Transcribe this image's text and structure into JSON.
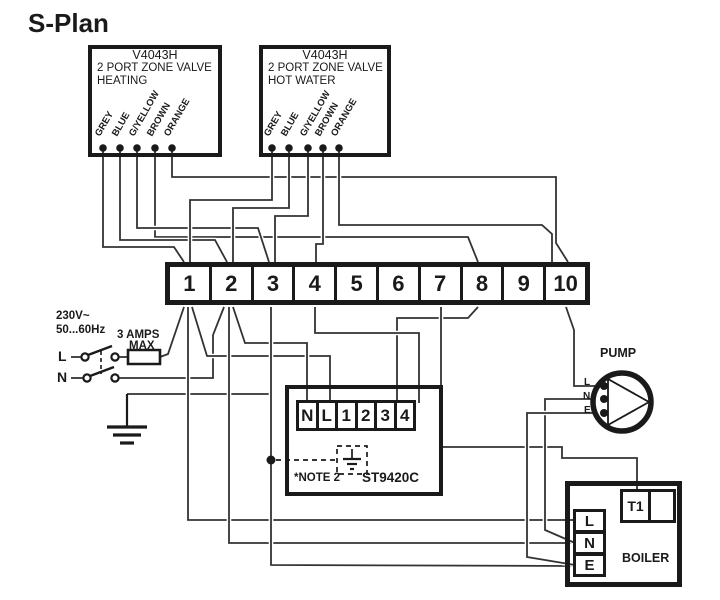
{
  "title": "S-Plan",
  "valves": [
    {
      "model": "V4043H",
      "type": "2 PORT ZONE VALVE",
      "circuit": "HEATING",
      "wires": [
        "GREY",
        "BLUE",
        "G/YELLOW",
        "BROWN",
        "ORANGE"
      ]
    },
    {
      "model": "V4043H",
      "type": "2 PORT ZONE VALVE",
      "circuit": "HOT WATER",
      "wires": [
        "GREY",
        "BLUE",
        "G/YELLOW",
        "BROWN",
        "ORANGE"
      ]
    }
  ],
  "terminal_strip": {
    "terminals": [
      "1",
      "2",
      "3",
      "4",
      "5",
      "6",
      "7",
      "8",
      "9",
      "10"
    ]
  },
  "mains": {
    "voltage": "230V~",
    "frequency": "50...60Hz",
    "fuse_line1": "3 AMPS",
    "fuse_line2": "MAX",
    "live": "L",
    "neutral": "N"
  },
  "programmer": {
    "model": "ST9420C",
    "note": "*NOTE 2",
    "terminals": [
      "N",
      "L",
      "1",
      "2",
      "3",
      "4"
    ]
  },
  "pump": {
    "label": "PUMP",
    "terminals": [
      "L",
      "N",
      "E"
    ]
  },
  "boiler": {
    "label": "BOILER",
    "t1": "T1",
    "terminals": [
      "L",
      "N",
      "E"
    ]
  },
  "colors": {
    "line": "#1a1a1a",
    "wire": "#333333",
    "background": "#ffffff"
  },
  "connections": [
    "Mains L via DP switch and 3 A fuse to strip 1",
    "Mains N to strip 2",
    "Installation earth to strip 3",
    "Heating valve GREY/BLUE/G-YELLOW to strip 1/2/3, BROWN to strip 8, ORANGE to strip 10",
    "Hot water valve GREY/BLUE/G-YELLOW to strip 1/2/3, BROWN to strip 4, ORANGE to strip 10",
    "ST9420C N to strip 2, L to strip 1, terminal 3 to strip 8, terminal 4 to strip 4",
    "Pump L from strip 10, N and E teed into boiler N and E runs",
    "Boiler L/N/E from strip 1/2/3, T1 from strip 7",
    "*NOTE 2: dashed earth link from strip 3 run to ST9420C earth"
  ]
}
